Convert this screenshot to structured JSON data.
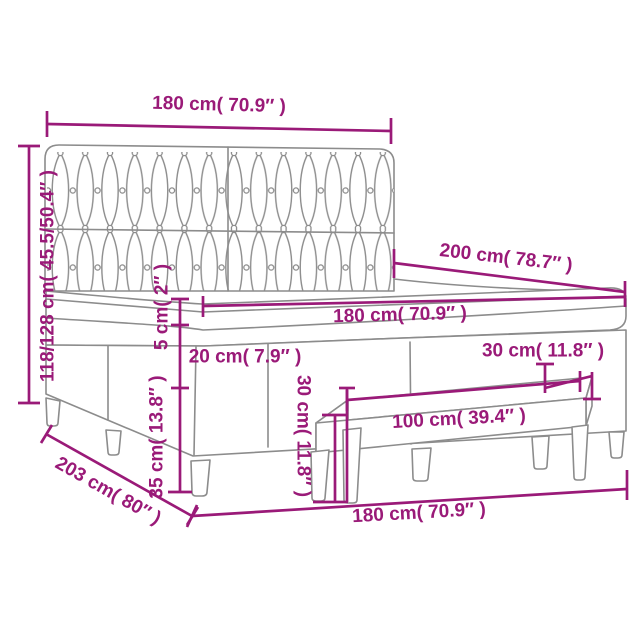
{
  "diagram": {
    "type": "product-dimension-diagram",
    "subject": "box spring bed with tufted headboard, mattress topper and bench",
    "colors": {
      "accent": "#9a1a78",
      "line": "#8c8c8c",
      "background": "#ffffff"
    },
    "labels": {
      "bed_width_top": "180 cm( 70.9″ )",
      "headboard_height": "118/128 cm( 45.5/50.4″ )",
      "bed_length": "200 cm( 78.7″ )",
      "mattress_width": "180 cm( 70.9″ )",
      "topper_thickness": "5 cm( 2″ )",
      "mattress_thickness": "20 cm( 7.9″ )",
      "base_height": "35 cm( 13.8″ )",
      "bench_depth": "30 cm( 11.8″ )",
      "bench_height": "30 cm( 11.8″ )",
      "bench_length": "100 cm( 39.4″ )",
      "total_length": "203 cm( 80″ )",
      "bed_width_bottom": "180 cm( 70.9″ )"
    }
  }
}
